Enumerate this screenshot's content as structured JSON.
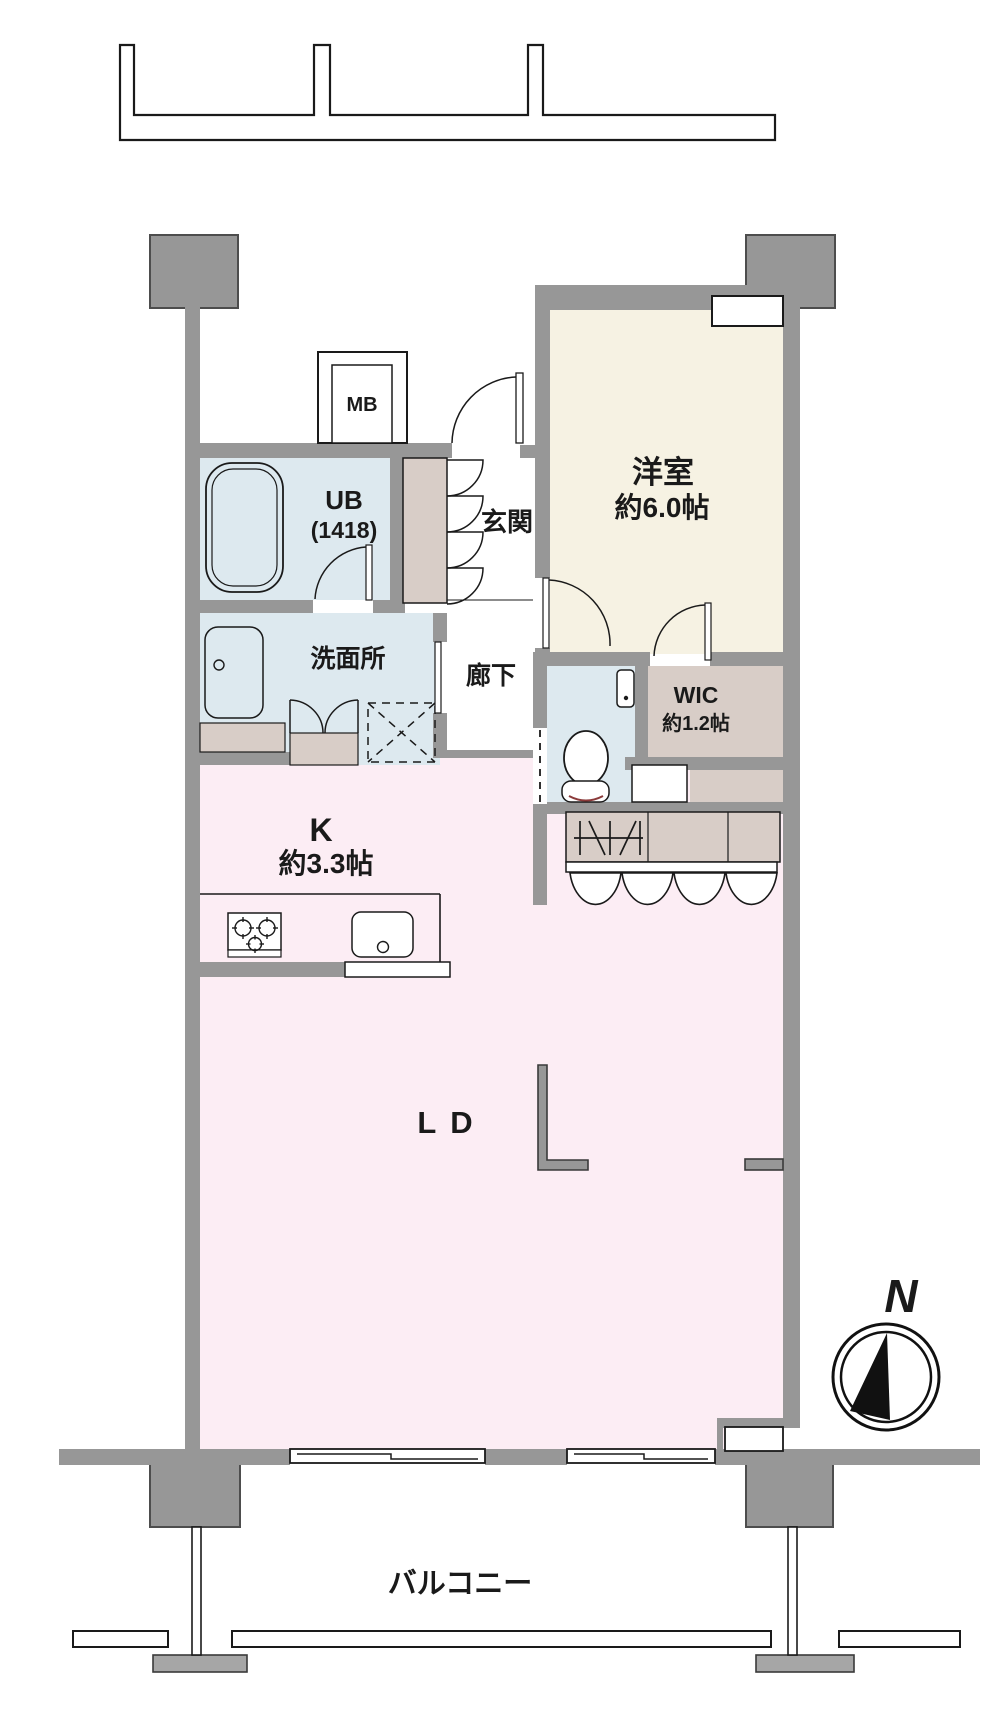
{
  "title": "マンション間取り図",
  "colors": {
    "wall_gray": "#979797",
    "pillar_gray": "#979797",
    "outline_black": "#1a1a1a",
    "room_pink_ldk": "#fcedf4",
    "room_cream_bedroom": "#f6f2e3",
    "room_blue_wet": "#dde9ef",
    "room_beige_storage": "#d8cdc7",
    "balcony_block_gray": "#a6a6a6",
    "toilet_accent_red": "#8b3a3a"
  },
  "rooms": {
    "western_room": {
      "name": "洋室",
      "size": "約6.0帖"
    },
    "kitchen": {
      "name": "K",
      "size": "約3.3帖"
    },
    "living_dining": {
      "name": "LD"
    },
    "unit_bath": {
      "name": "UB",
      "size": "(1418)"
    },
    "washroom": {
      "name": "洗面所"
    },
    "hallway": {
      "name": "廊下"
    },
    "entrance": {
      "name": "玄関"
    },
    "wic": {
      "name": "WIC",
      "size": "約1.2帖"
    },
    "meter_box": {
      "name": "MB"
    },
    "balcony": {
      "name": "バルコニー"
    }
  },
  "compass": {
    "label": "N"
  }
}
